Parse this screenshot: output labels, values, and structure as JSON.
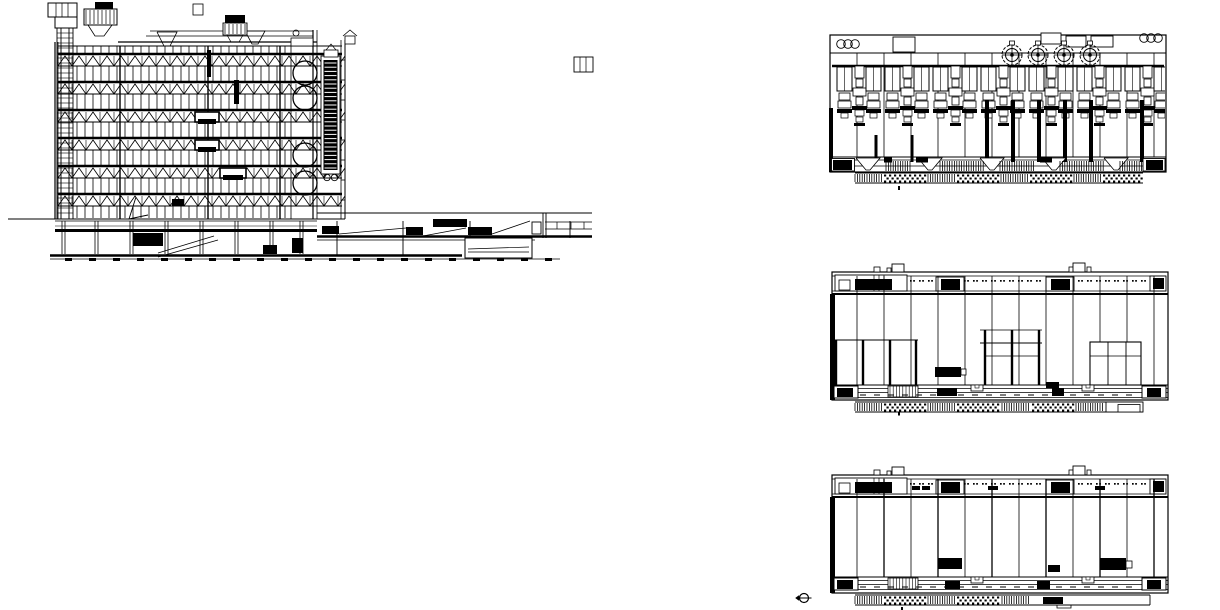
{
  "page": {
    "background": "#ffffff",
    "ink": "#000000"
  },
  "views": {
    "section": {
      "name": "building-section",
      "floors": 6,
      "floor_start_y": 54,
      "floor_spacing": 28,
      "mullion_pitch": 8,
      "truss_period": 14,
      "duct_circle_y": [
        73,
        98,
        155,
        183
      ],
      "duct_circle_x": 305,
      "duct_circle_r": 12
    },
    "machinery_elevation": {
      "name": "roof-machinery-elevation",
      "bays": [
        857,
        884,
        911,
        938,
        965,
        992,
        1019,
        1046,
        1073,
        1100,
        1127,
        1154
      ],
      "module_count": 7,
      "module_start_x": 836,
      "module_pitch": 48,
      "fan_count": 4,
      "fan_start_x": 1012,
      "fan_pitch": 26,
      "fan_y": 55,
      "corner_circles_left_x": 841,
      "corner_circles_right_x": 1144,
      "circles_per_corner": 3,
      "drop_columns": [
        987,
        1013,
        1039,
        1065,
        1091,
        1142
      ],
      "top_rects": [
        [
          893,
          37,
          22,
          15
        ],
        [
          1041,
          33,
          20,
          11
        ],
        [
          1066,
          36,
          20,
          11
        ],
        [
          1091,
          36,
          22,
          11
        ]
      ]
    },
    "upper_elevation": {
      "name": "upper-floor-elevation",
      "black_unit_x": [
        855,
        941,
        1051,
        1153
      ],
      "room_walls_left": [
        836,
        863,
        890,
        916
      ],
      "room_walls_center": [
        985,
        1012,
        1039
      ]
    },
    "lower_elevation": {
      "name": "lower-floor-elevation",
      "black_unit_x": [
        855,
        941,
        1051,
        1153
      ],
      "floor_blocks": [
        [
          938,
          558,
          24,
          11
        ],
        [
          1048,
          565,
          12,
          7
        ],
        [
          1100,
          558,
          26,
          12
        ]
      ]
    }
  },
  "symbols": {
    "datum_marker": "circle-with-axis-line"
  }
}
